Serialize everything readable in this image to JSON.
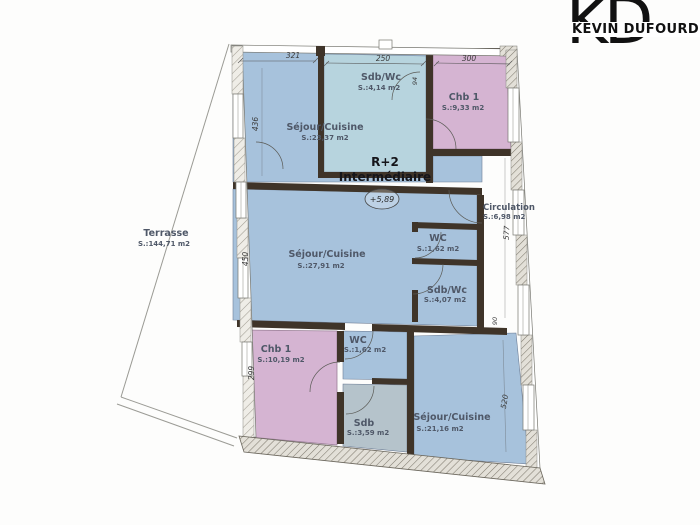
{
  "logo": {
    "wordmark": "KEVIN DUFOURD",
    "monogram_left": "K",
    "monogram_right": "D"
  },
  "plan": {
    "level": {
      "line1": "R+2",
      "line2": "Intermédiaire"
    },
    "elevation_marker": "+5,89",
    "rooms": [
      {
        "name": "Séjour/Cuisine",
        "area": "S.:23,37 m2"
      },
      {
        "name": "Sdb/Wc",
        "area": "S.:4,14 m2"
      },
      {
        "name": "Chb 1",
        "area": "S.:9,33 m2"
      },
      {
        "name": "Circulation",
        "area": "S.:6,98 m2"
      },
      {
        "name": "Séjour/Cuisine",
        "area": "S.:27,91 m2"
      },
      {
        "name": "WC",
        "area": "S.:1,62 m2"
      },
      {
        "name": "Sdb/Wc",
        "area": "S.:4,07 m2"
      },
      {
        "name": "Terrasse",
        "area": "S.:144,71 m2"
      },
      {
        "name": "Chb 1",
        "area": "S.:10,19 m2"
      },
      {
        "name": "WC",
        "area": "S.:1,62 m2"
      },
      {
        "name": "Sdb",
        "area": "S.:3,59 m2"
      },
      {
        "name": "Séjour/Cuisine",
        "area": "S.:21,16 m2"
      }
    ],
    "dimensions": {
      "top_left": "321",
      "top_middle": "250",
      "top_right": "300",
      "left_upper": "436",
      "left_middle": "450",
      "left_lower": "299",
      "right_upper": "577",
      "right_lower": "520",
      "door_width": "90",
      "window_width": "94"
    },
    "colors": {
      "room_blue": "#a7c2dc",
      "room_blue_light": "#b7d4de",
      "room_pink": "#d5b4d2",
      "room_gray": "#b5c3cb",
      "wall": "#3f3429"
    }
  }
}
